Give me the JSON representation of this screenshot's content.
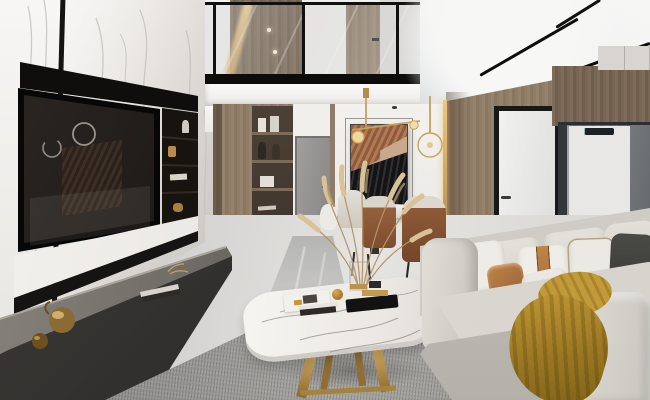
{
  "scene": {
    "type": "interior-photograph",
    "room": "modern duplex living room with mezzanine, dining nook and marble TV wall",
    "style": "luxury contemporary; white marble, warm wood, brass and caramel leather accents",
    "palette": {
      "marble_white": "#ece9e5",
      "vein_gray": "#c0bdb8",
      "tv_black": "#0a0a09",
      "wood_warm": "#95826d",
      "wood_dark": "#6b5c4b",
      "accent_brass": "#c9a35a",
      "leather_caramel": "#a8703f",
      "sofa_cream": "#d9d6cf",
      "throw_mustard": "#a9852a",
      "rug_gray": "#9a9997",
      "floor_gray": "#d9d8d5",
      "bench_charcoal": "#3a3836",
      "art_copper": "#a06246",
      "art_black": "#1c1c1e",
      "fridge_graphite": "#53565a",
      "wall_white": "#f2f1ef"
    },
    "objects": [
      {
        "name": "marble-feature-wall",
        "color": "#ece9e5"
      },
      {
        "name": "wall-mounted-tv",
        "color": "#0a0a09"
      },
      {
        "name": "media-shelf-niche",
        "color": "#171410"
      },
      {
        "name": "stone-media-bench",
        "color": "#3a3836"
      },
      {
        "name": "brass-teapot-decor",
        "color": "#a07c3e"
      },
      {
        "name": "mezzanine-glass-railing",
        "color": "#101010"
      },
      {
        "name": "upper-floor-wood-door",
        "color": "#9c8c79"
      },
      {
        "name": "wardrobe-display-shelf",
        "color": "#7e6e5c"
      },
      {
        "name": "hallway-door",
        "color": "#97968f"
      },
      {
        "name": "abstract-artwork",
        "color": "#a06246"
      },
      {
        "name": "brass-pendant-light",
        "color": "#c9a35a"
      },
      {
        "name": "dining-table",
        "color": "#efede9"
      },
      {
        "name": "dining-chairs",
        "color": "#8a5638"
      },
      {
        "name": "pampas-grass-arrangement",
        "color": "#d2b78c"
      },
      {
        "name": "marble-coffee-table",
        "color": "#f3f1ed"
      },
      {
        "name": "area-rug",
        "color": "#9a9997"
      },
      {
        "name": "sectional-sofa",
        "color": "#d9d6cf"
      },
      {
        "name": "accent-cushions",
        "color": "#a8703f"
      },
      {
        "name": "mustard-throw-blanket",
        "color": "#a9852a"
      },
      {
        "name": "white-interior-door",
        "color": "#e9e9e7"
      },
      {
        "name": "brass-light-strip",
        "color": "#d8b06a"
      },
      {
        "name": "refrigerator",
        "color": "#53565a"
      },
      {
        "name": "dark-stone-counter",
        "color": "#17181a"
      },
      {
        "name": "curved-feature-ceiling",
        "color": "#eef0f1"
      },
      {
        "name": "linear-track-lights",
        "color": "#0d0d0d"
      }
    ]
  }
}
